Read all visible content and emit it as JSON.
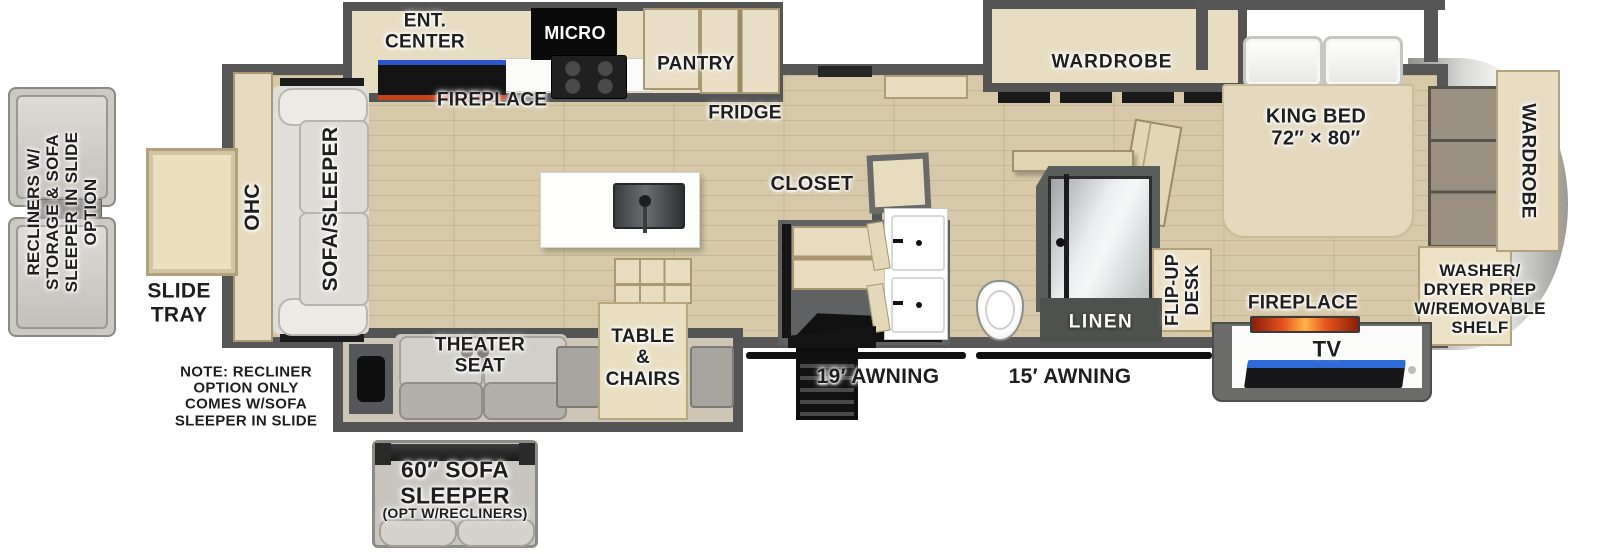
{
  "floorplan": {
    "exterior_options": {
      "recliners_option": "RECLINERS W/\nSTORAGE & SOFA\nSLEEPER IN SLIDE\nOPTION",
      "slide_tray": "SLIDE\nTRAY",
      "note": "NOTE: RECLINER\nOPTION ONLY\nCOMES W/SOFA\nSLEEPER IN SLIDE",
      "sofa60_main": "60″ SOFA\nSLEEPER",
      "sofa60_sub": "(OPT W/RECLINERS)"
    },
    "living_area": {
      "ohc": "OHC",
      "sofa_sleeper": "SOFA/SLEEPER",
      "ent_center": "ENT.\nCENTER",
      "fireplace": "FIREPLACE",
      "theater_seat": "THEATER\nSEAT",
      "table_chairs": "TABLE\n&\nCHAIRS"
    },
    "kitchen": {
      "micro": "MICRO",
      "pantry": "PANTRY",
      "fridge": "FRIDGE",
      "closet": "CLOSET"
    },
    "bathroom": {
      "linen": "LINEN",
      "flip_up_desk": "FLIP-UP\nDESK"
    },
    "bedroom": {
      "wardrobe_bedroom": "WARDROBE",
      "king_bed": "KING BED\n72″ × 80″",
      "fireplace": "FIREPLACE",
      "tv": "TV",
      "wardrobe_front": "WARDROBE",
      "washer_dryer": "WASHER/\nDRYER PREP\nW/REMOVABLE\nSHELF"
    },
    "awnings": {
      "awning_19": "19′ AWNING",
      "awning_15": "15′ AWNING"
    },
    "colors": {
      "wall_gray": "#565656",
      "floor_wood": "#d6c8a8",
      "cabinet_tan": "#e8ddc1",
      "flame_accent": "#e8541c",
      "tv_blue": "#2f6bd8",
      "label_text": "#1e1e1e"
    }
  }
}
